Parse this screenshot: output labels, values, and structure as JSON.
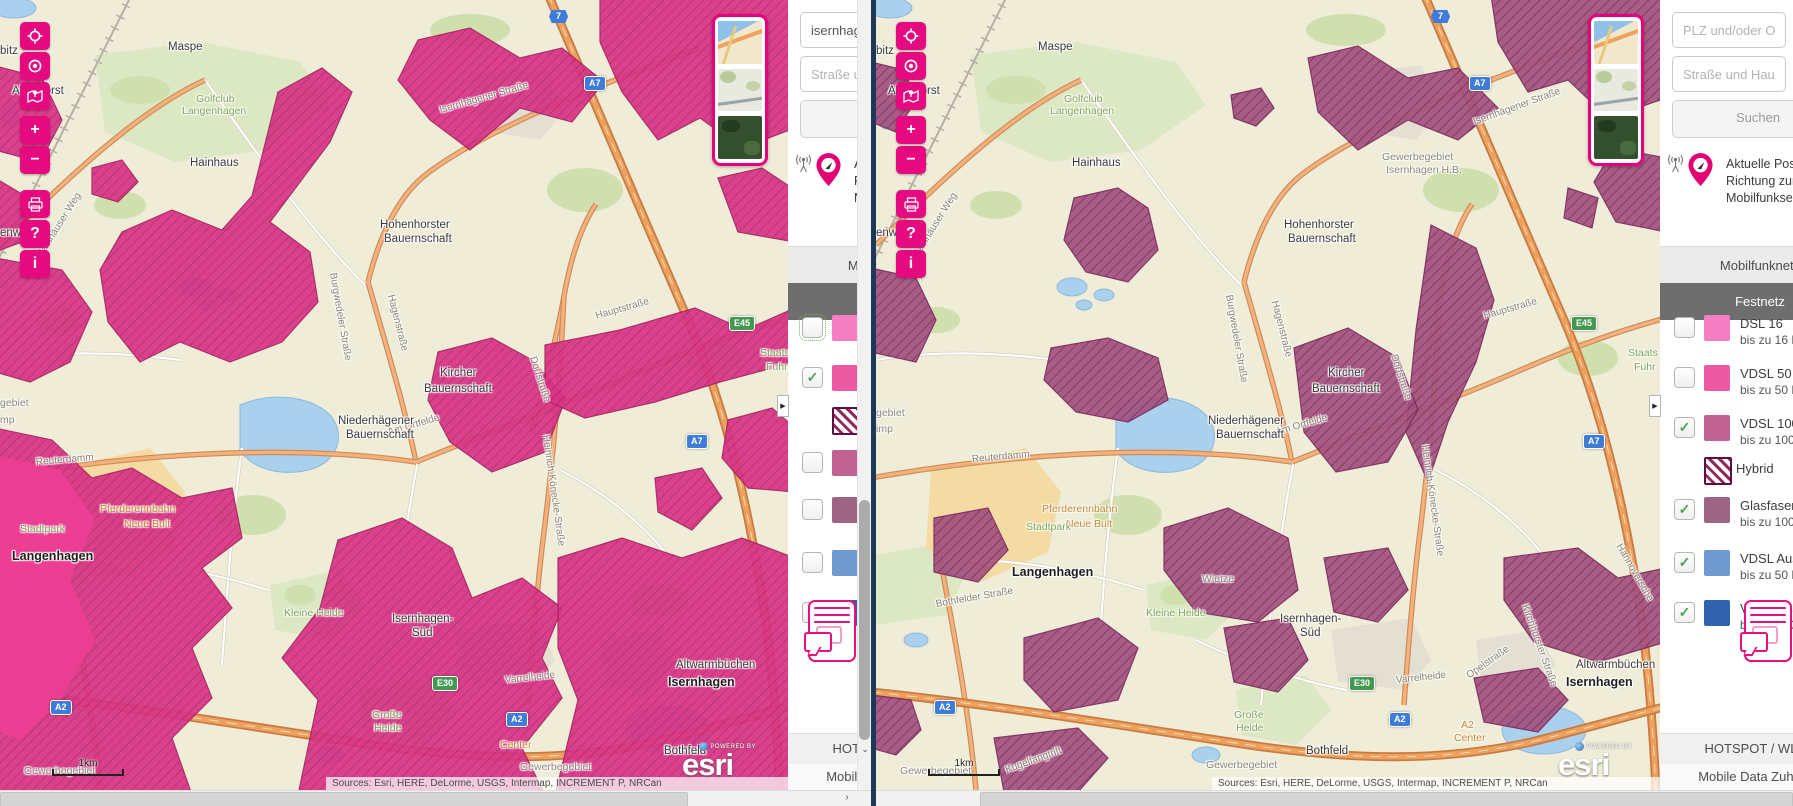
{
  "toolbar": {
    "zoom_in": "+",
    "zoom_out": "−",
    "help": "?",
    "info": "i",
    "buttons": [
      "zoom-extent",
      "locate",
      "legend-map",
      "zoom-in",
      "zoom-out",
      "print",
      "help",
      "info"
    ]
  },
  "search": {
    "plz_placeholder": "PLZ und/oder Ort",
    "street_placeholder": "Straße und Hausnummer",
    "button_label": "Suchen",
    "left_query": "isernhagen"
  },
  "info": {
    "line1": "Aktuelle Position",
    "line2": "Richtung zum nächsten",
    "line3": "Mobilfunksender"
  },
  "tabs": {
    "mobile": "Mobilfunknetz",
    "fixed": "Festnetz"
  },
  "legend": {
    "items": [
      {
        "id": "dsl16",
        "label": "DSL 16",
        "sub": "bis zu 16 MBit/s",
        "color": "#f57fc0"
      },
      {
        "id": "vdsl50",
        "label": "VDSL 50",
        "sub": "bis zu 50 MBit/s",
        "color": "#ec5aa4"
      },
      {
        "id": "vdsl100",
        "label": "VDSL 100",
        "sub": "bis zu 100 MBit/s",
        "color": "#bf6191"
      },
      {
        "id": "glasfaser",
        "label": "Glasfaser",
        "sub": "bis zu 1000 MBit/s",
        "color": "#9d6484"
      },
      {
        "id": "ausbau50",
        "label": "VDSL Ausbau",
        "sub": "bis zu 50 MBit/s",
        "color": "#6f9ad0"
      },
      {
        "id": "ausbau100",
        "label": "VDSL Ausbau",
        "sub": "bis zu 100 MBit/s",
        "color": "#2f64ad"
      }
    ],
    "hybrid_label": "Hybrid",
    "hybrid_stripe": "#8f2b5f",
    "hybrid_border": "#650a3c"
  },
  "panel_state": {
    "left": {
      "checked": [
        "vdsl50"
      ],
      "focused": "dsl16",
      "hybrid_after": "vdsl50"
    },
    "right": {
      "checked": [
        "vdsl100",
        "glasfaser",
        "ausbau50",
        "ausbau100"
      ],
      "focused": null,
      "hybrid_after": "vdsl100"
    }
  },
  "footer": {
    "hotspot": "HOTSPOT / WLAN",
    "mobile_data": "Mobile Data Zuhause"
  },
  "map": {
    "scale_label": "1km",
    "attribution": "Sources: Esri, HERE, DeLorme, USGS, Intermap, INCREMENT P, NRCan",
    "powered_by": "POWERED BY",
    "esri": "esri",
    "expander": "▶",
    "accent": "#e6007e",
    "coverage_left_color": "#d93486",
    "coverage_right_color": "#a4527f",
    "shields_left": [
      {
        "type": "blue",
        "hex": true,
        "t": "7",
        "x": 549,
        "y": 10
      },
      {
        "type": "blue",
        "t": "A7",
        "x": 584,
        "y": 76
      },
      {
        "type": "blue",
        "t": "A7",
        "x": 686,
        "y": 434
      },
      {
        "type": "green",
        "t": "E45",
        "x": 729,
        "y": 316
      },
      {
        "type": "green",
        "t": "E30",
        "x": 432,
        "y": 676
      },
      {
        "type": "blue",
        "t": "A2",
        "x": 50,
        "y": 700
      },
      {
        "type": "blue",
        "t": "A2",
        "x": 506,
        "y": 712
      }
    ],
    "shields_right": [
      {
        "type": "blue",
        "hex": true,
        "t": "7",
        "x": 555,
        "y": 10
      },
      {
        "type": "blue",
        "t": "A7",
        "x": 593,
        "y": 76
      },
      {
        "type": "blue",
        "t": "A7",
        "x": 707,
        "y": 434
      },
      {
        "type": "green",
        "t": "E45",
        "x": 695,
        "y": 316
      },
      {
        "type": "green",
        "t": "E30",
        "x": 473,
        "y": 676
      },
      {
        "type": "blue",
        "t": "A2",
        "x": 58,
        "y": 700
      },
      {
        "type": "blue",
        "t": "A2",
        "x": 513,
        "y": 712
      }
    ],
    "labels_left": [
      {
        "t": "Maspe",
        "x": 168,
        "y": 42,
        "c": "town"
      },
      {
        "t": "Golfclub",
        "x": 196,
        "y": 94,
        "c": "green"
      },
      {
        "t": "Langenhagen",
        "x": 182,
        "y": 106,
        "c": "green"
      },
      {
        "t": "bitz",
        "x": 0,
        "y": 46,
        "c": "town"
      },
      {
        "t": "Altenhorst",
        "x": 12,
        "y": 86,
        "c": "town"
      },
      {
        "t": "Hainhaus",
        "x": 190,
        "y": 158,
        "c": "town"
      },
      {
        "t": "Isernhägener Straße",
        "x": 440,
        "y": 106,
        "c": "street",
        "r": -16
      },
      {
        "t": "Hainhäuser Weg",
        "x": 40,
        "y": 252,
        "c": "street",
        "r": -58
      },
      {
        "t": "Hohenhorster",
        "x": 380,
        "y": 220,
        "c": "town"
      },
      {
        "t": "Bauernschaft",
        "x": 384,
        "y": 234,
        "c": "town"
      },
      {
        "t": "Hagenstraße",
        "x": 390,
        "y": 290,
        "c": "street",
        "r": 76
      },
      {
        "t": "Burgwedeler Straße",
        "x": 332,
        "y": 268,
        "c": "street",
        "r": 80
      },
      {
        "t": "Kircher",
        "x": 440,
        "y": 368,
        "c": "town"
      },
      {
        "t": "Bauernschaft",
        "x": 424,
        "y": 384,
        "c": "town"
      },
      {
        "t": "Dorfstraße",
        "x": 532,
        "y": 352,
        "c": "street",
        "r": 72
      },
      {
        "t": "Hauptstraße",
        "x": 596,
        "y": 312,
        "c": "street",
        "r": -16
      },
      {
        "t": "Heinrich-Könecke-Straße",
        "x": 545,
        "y": 430,
        "c": "street",
        "r": 82
      },
      {
        "t": "Am Ortfelde",
        "x": 388,
        "y": 428,
        "c": "street",
        "r": -16
      },
      {
        "t": "Niederhägener",
        "x": 338,
        "y": 416,
        "c": "town"
      },
      {
        "t": "Bauernschaft",
        "x": 346,
        "y": 430,
        "c": "town"
      },
      {
        "t": "Reuterdamm",
        "x": 36,
        "y": 458,
        "c": "street",
        "r": -5
      },
      {
        "t": "Pferderennbahn",
        "x": 100,
        "y": 504,
        "c": "orange"
      },
      {
        "t": "Neue Bult",
        "x": 124,
        "y": 519,
        "c": "orange"
      },
      {
        "t": "Stadtpark",
        "x": 20,
        "y": 524,
        "c": "green"
      },
      {
        "t": "Langenhagen",
        "x": 12,
        "y": 550,
        "c": "townbold"
      },
      {
        "t": "Kleine Heide",
        "x": 284,
        "y": 608,
        "c": "green"
      },
      {
        "t": "Isernhagen-",
        "x": 392,
        "y": 614,
        "c": "town"
      },
      {
        "t": "Süd",
        "x": 412,
        "y": 628,
        "c": "town"
      },
      {
        "t": "Varrelheide",
        "x": 505,
        "y": 676,
        "c": "street",
        "r": -6
      },
      {
        "t": "Altwarmbüchen",
        "x": 676,
        "y": 660,
        "c": "town"
      },
      {
        "t": "Isernhagen",
        "x": 668,
        "y": 676,
        "c": "townbold"
      },
      {
        "t": "Große",
        "x": 372,
        "y": 710,
        "c": "green"
      },
      {
        "t": "Heide",
        "x": 374,
        "y": 723,
        "c": "green"
      },
      {
        "t": "Staats",
        "x": 760,
        "y": 348,
        "c": "green"
      },
      {
        "t": "Fuhr",
        "x": 766,
        "y": 362,
        "c": "green"
      },
      {
        "t": "gebiet",
        "x": 0,
        "y": 398,
        "c": "gray"
      },
      {
        "t": "mp",
        "x": 0,
        "y": 415,
        "c": "gray"
      },
      {
        "t": "enw",
        "x": 0,
        "y": 228,
        "c": "town"
      },
      {
        "t": "Center",
        "x": 500,
        "y": 740,
        "c": "orange"
      },
      {
        "t": "Bothfeld",
        "x": 664,
        "y": 746,
        "c": "town"
      },
      {
        "t": "Gewerbegebiet",
        "x": 24,
        "y": 766,
        "c": "gray"
      },
      {
        "t": "Gewerbegebiet",
        "x": 520,
        "y": 762,
        "c": "gray"
      }
    ],
    "labels_right": [
      {
        "t": "Maspe",
        "x": 162,
        "y": 42,
        "c": "town"
      },
      {
        "t": "Golfclub",
        "x": 188,
        "y": 94,
        "c": "green"
      },
      {
        "t": "Langenhagen",
        "x": 174,
        "y": 106,
        "c": "green"
      },
      {
        "t": "bitz",
        "x": 0,
        "y": 46,
        "c": "town"
      },
      {
        "t": "Altenhorst",
        "x": 12,
        "y": 86,
        "c": "town"
      },
      {
        "t": "Hainhaus",
        "x": 196,
        "y": 158,
        "c": "town"
      },
      {
        "t": "Gewerbegebiet",
        "x": 506,
        "y": 152,
        "c": "gray"
      },
      {
        "t": "Isernhagen H.B.",
        "x": 510,
        "y": 165,
        "c": "gray"
      },
      {
        "t": "Isernhägener Straße",
        "x": 598,
        "y": 118,
        "c": "street",
        "r": -20
      },
      {
        "t": "Hainhäuser Weg",
        "x": 40,
        "y": 252,
        "c": "street",
        "r": -58
      },
      {
        "t": "Hohenhorster",
        "x": 408,
        "y": 220,
        "c": "town"
      },
      {
        "t": "Bauernschaft",
        "x": 412,
        "y": 234,
        "c": "town"
      },
      {
        "t": "Hagenstraße",
        "x": 398,
        "y": 296,
        "c": "street",
        "r": 76
      },
      {
        "t": "Burgwedeler Straße",
        "x": 352,
        "y": 290,
        "c": "street",
        "r": 80
      },
      {
        "t": "Kircher",
        "x": 452,
        "y": 368,
        "c": "town"
      },
      {
        "t": "Bauernschaft",
        "x": 436,
        "y": 384,
        "c": "town"
      },
      {
        "t": "Dorfstraße",
        "x": 517,
        "y": 350,
        "c": "street",
        "r": 72
      },
      {
        "t": "Hauptstraße",
        "x": 608,
        "y": 312,
        "c": "street",
        "r": -16
      },
      {
        "t": "Heinrich-Könecke-Straße",
        "x": 548,
        "y": 440,
        "c": "street",
        "r": 82
      },
      {
        "t": "Am Ortfelde",
        "x": 400,
        "y": 428,
        "c": "street",
        "r": -16
      },
      {
        "t": "Niederhägener",
        "x": 332,
        "y": 416,
        "c": "town"
      },
      {
        "t": "Bauernschaft",
        "x": 340,
        "y": 430,
        "c": "town"
      },
      {
        "t": "Reuterdamm",
        "x": 96,
        "y": 455,
        "c": "street",
        "r": -5
      },
      {
        "t": "Pferderennbahn",
        "x": 166,
        "y": 504,
        "c": "orange"
      },
      {
        "t": "Neue Bult",
        "x": 190,
        "y": 519,
        "c": "orange"
      },
      {
        "t": "Stadtpark",
        "x": 150,
        "y": 522,
        "c": "green"
      },
      {
        "t": "Langenhagen",
        "x": 136,
        "y": 566,
        "c": "townbold"
      },
      {
        "t": "Wietze",
        "x": 326,
        "y": 574,
        "c": "gray"
      },
      {
        "t": "Bothfelder Straße",
        "x": 60,
        "y": 600,
        "c": "street",
        "r": -10
      },
      {
        "t": "Kleine Heide",
        "x": 270,
        "y": 608,
        "c": "green"
      },
      {
        "t": "Isernhagen-",
        "x": 404,
        "y": 614,
        "c": "town"
      },
      {
        "t": "Süd",
        "x": 424,
        "y": 628,
        "c": "town"
      },
      {
        "t": "Varrelheide",
        "x": 520,
        "y": 676,
        "c": "street",
        "r": -6
      },
      {
        "t": "Opelstraße",
        "x": 592,
        "y": 672,
        "c": "street",
        "r": -35
      },
      {
        "t": "Kirchhorster Straße",
        "x": 648,
        "y": 600,
        "c": "street",
        "r": 70
      },
      {
        "t": "Hannoversche",
        "x": 742,
        "y": 540,
        "c": "street",
        "r": 60
      },
      {
        "t": "Altwarmbüchen",
        "x": 700,
        "y": 660,
        "c": "town"
      },
      {
        "t": "Isernhagen",
        "x": 690,
        "y": 676,
        "c": "townbold"
      },
      {
        "t": "Große",
        "x": 358,
        "y": 710,
        "c": "green"
      },
      {
        "t": "Heide",
        "x": 360,
        "y": 723,
        "c": "green"
      },
      {
        "t": "Staats",
        "x": 752,
        "y": 348,
        "c": "green"
      },
      {
        "t": "Fuhr",
        "x": 758,
        "y": 362,
        "c": "green"
      },
      {
        "t": "gebiet",
        "x": 0,
        "y": 408,
        "c": "gray"
      },
      {
        "t": "imp",
        "x": 0,
        "y": 424,
        "c": "gray"
      },
      {
        "t": "enw",
        "x": 0,
        "y": 228,
        "c": "town"
      },
      {
        "t": "A2",
        "x": 585,
        "y": 720,
        "c": "orange"
      },
      {
        "t": "Center",
        "x": 578,
        "y": 733,
        "c": "orange"
      },
      {
        "t": "Kugelfangtrift",
        "x": 130,
        "y": 766,
        "c": "street",
        "r": -20
      },
      {
        "t": "Bothfeld",
        "x": 430,
        "y": 746,
        "c": "town"
      },
      {
        "t": "Gewerbegebiet",
        "x": 24,
        "y": 766,
        "c": "gray"
      },
      {
        "t": "Gewerbegebiet",
        "x": 330,
        "y": 760,
        "c": "gray"
      }
    ]
  }
}
